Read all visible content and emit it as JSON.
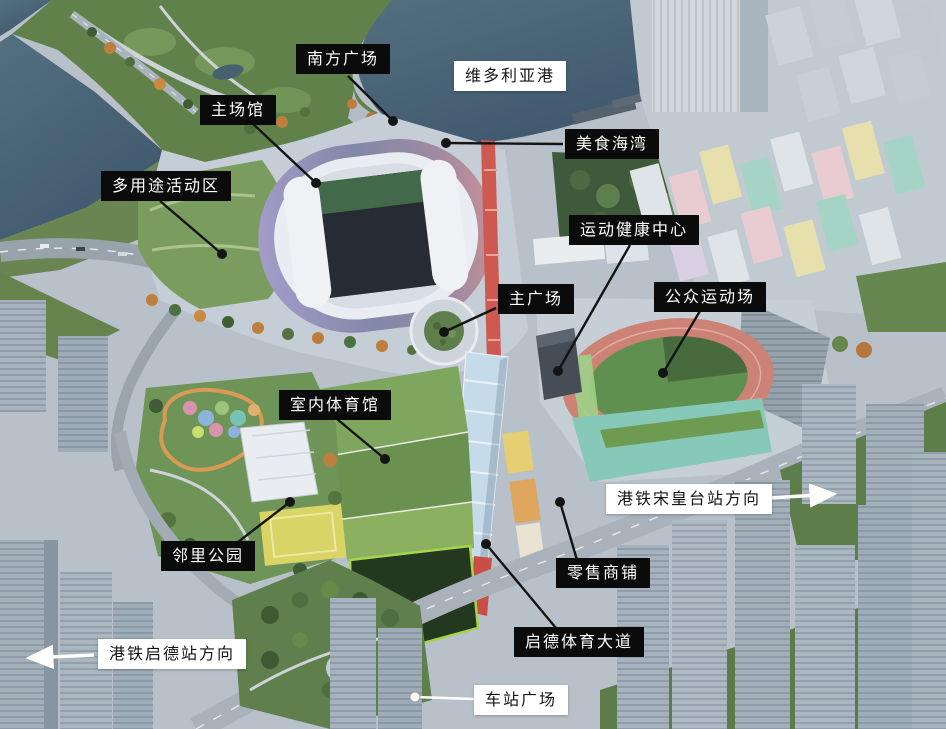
{
  "colors": {
    "label_dark_bg": "#0b0b0b",
    "label_dark_text": "#ffffff",
    "label_light_bg": "#ffffff",
    "label_light_text": "#151515",
    "leader_dark": "#141414",
    "leader_light": "#ffffff",
    "arrow_white": "#ffffff",
    "water": "#4a6578",
    "stadium_rim_left": "#a39cc8",
    "stadium_rim_right": "#c48f97",
    "running_track": "#cc8275",
    "pitch_green": "#60904f",
    "canopy_blue": "#c6dbea",
    "walkway_red": "#cd5950"
  },
  "labels": [
    {
      "id": "south-plaza",
      "text": "南方广场",
      "style": "dark",
      "leader": {
        "x1": 348,
        "y1": 76,
        "x2": 393,
        "y2": 121
      }
    },
    {
      "id": "victoria-harbour",
      "text": "维多利亚港",
      "style": "light"
    },
    {
      "id": "main-stadium",
      "text": "主场馆",
      "style": "dark",
      "leader": {
        "x1": 252,
        "y1": 123,
        "x2": 316,
        "y2": 183
      }
    },
    {
      "id": "food-bay",
      "text": "美食海湾",
      "style": "dark",
      "leader": {
        "x1": 563,
        "y1": 144,
        "x2": 446,
        "y2": 143
      }
    },
    {
      "id": "multi-purpose-activity-zone",
      "text": "多用途活动区",
      "style": "dark",
      "leader": {
        "x1": 160,
        "y1": 201,
        "x2": 222,
        "y2": 254
      }
    },
    {
      "id": "sports-health-centre",
      "text": "运动健康中心",
      "style": "dark",
      "leader": {
        "x1": 630,
        "y1": 245,
        "x2": 558,
        "y2": 371
      }
    },
    {
      "id": "main-plaza",
      "text": "主广场",
      "style": "dark",
      "leader": {
        "x1": 496,
        "y1": 308,
        "x2": 444,
        "y2": 332
      }
    },
    {
      "id": "public-sports-ground",
      "text": "公众运动场",
      "style": "dark",
      "leader": {
        "x1": 700,
        "y1": 311,
        "x2": 663,
        "y2": 373
      }
    },
    {
      "id": "indoor-sports-hall",
      "text": "室内体育馆",
      "style": "dark",
      "leader": {
        "x1": 337,
        "y1": 419,
        "x2": 385,
        "y2": 459
      }
    },
    {
      "id": "mtr-sung-wong-toi-direction",
      "text": "港铁宋皇台站方向",
      "style": "light",
      "arrow": {
        "x1": 769,
        "y1": 498,
        "x2": 834,
        "y2": 494
      }
    },
    {
      "id": "neighbourhood-park",
      "text": "邻里公园",
      "style": "dark",
      "leader": {
        "x1": 238,
        "y1": 542,
        "x2": 290,
        "y2": 502
      }
    },
    {
      "id": "retail-shops",
      "text": "零售商铺",
      "style": "dark",
      "leader": {
        "x1": 577,
        "y1": 560,
        "x2": 560,
        "y2": 502
      }
    },
    {
      "id": "mtr-kai-tak-direction",
      "text": "港铁启德站方向",
      "style": "light",
      "arrow": {
        "x1": 94,
        "y1": 655,
        "x2": 29,
        "y2": 658
      }
    },
    {
      "id": "kai-tak-sports-avenue",
      "text": "启德体育大道",
      "style": "dark",
      "leader": {
        "x1": 556,
        "y1": 628,
        "x2": 486,
        "y2": 544
      }
    },
    {
      "id": "station-square",
      "text": "车站广场",
      "style": "light",
      "leader": {
        "x1": 474,
        "y1": 699,
        "x2": 415,
        "y2": 697
      }
    }
  ]
}
